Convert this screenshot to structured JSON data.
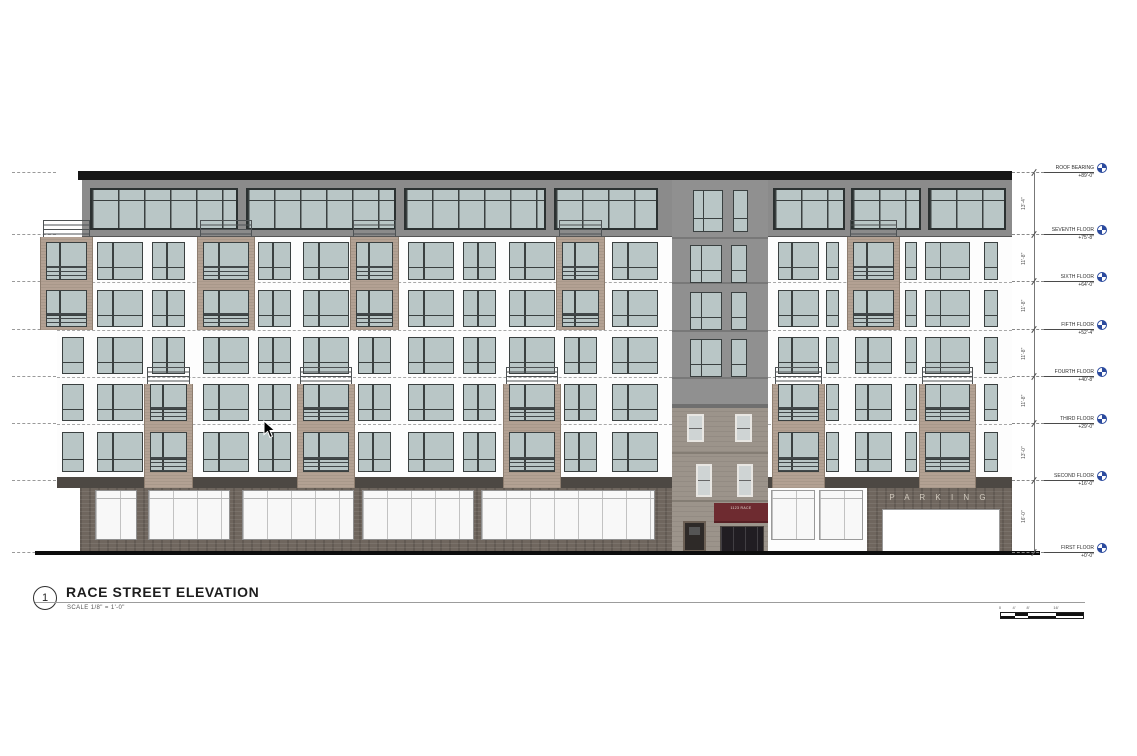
{
  "drawing": {
    "number": "1",
    "title": "RACE STREET ELEVATION",
    "scale_note": "SCALE  1/8\" = 1'-0\"",
    "parking_label": "P A R K I N G",
    "awning_text": "1123 RACE"
  },
  "levels": [
    {
      "name": "ROOF BEARING",
      "elev": "+89'-0\"",
      "y": 173
    },
    {
      "name": "SEVENTH FLOOR",
      "elev": "+75'-8\"",
      "y": 235
    },
    {
      "name": "SIXTH FLOOR",
      "elev": "+64'-0\"",
      "y": 282
    },
    {
      "name": "FIFTH FLOOR",
      "elev": "+52'-4\"",
      "y": 330
    },
    {
      "name": "FOURTH FLOOR",
      "elev": "+40'-8\"",
      "y": 377
    },
    {
      "name": "THIRD FLOOR",
      "elev": "+29'-0\"",
      "y": 424
    },
    {
      "name": "SECOND FLOOR",
      "elev": "+16'-0\"",
      "y": 481
    },
    {
      "name": "FIRST FLOOR",
      "elev": "+0'-0\"",
      "y": 553
    }
  ],
  "dimensions": [
    "13'-4\"",
    "11'-8\"",
    "11'-8\"",
    "11'-8\"",
    "11'-8\"",
    "13'-0\"",
    "16'-0\""
  ],
  "scale_bar": {
    "labels": [
      "0",
      "4'",
      "8'",
      "16'"
    ]
  },
  "icons": {
    "datum": "survey-datum-target-icon",
    "cursor": "mouse-pointer-icon"
  },
  "colors": {
    "roof_cap": "#161616",
    "band_gray": "#8b8b8b",
    "tower_gray": "#909090",
    "glass": "#b9c6c6",
    "frame": "#3a4040",
    "facade_white": "#fdfdfd",
    "tan_balcony": "#b3a193",
    "brick": "#6f665e",
    "stone": "#9c948b",
    "awning_maroon": "#6e2b30",
    "slab_dark": "#4d4843",
    "datum_blue": "#2b4a9e",
    "annotation_gray": "#777777"
  }
}
